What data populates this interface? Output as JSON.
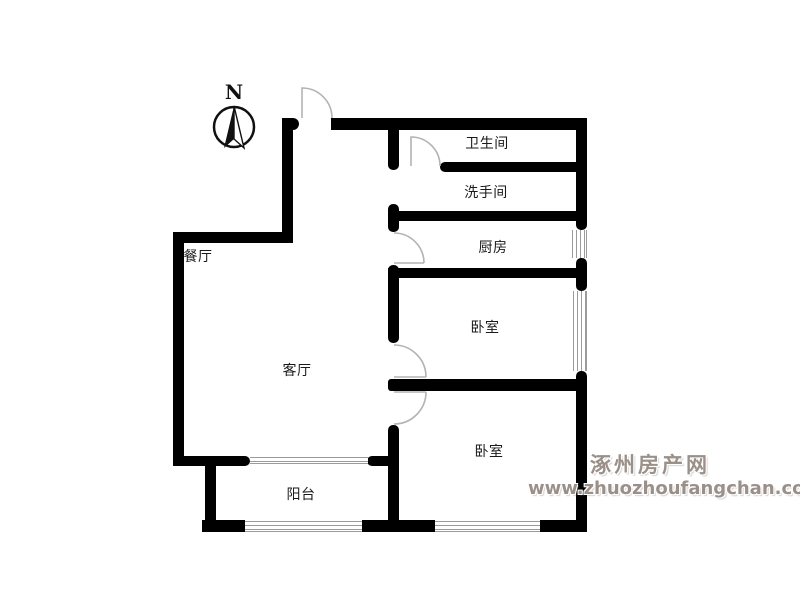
{
  "compass": {
    "label": "N"
  },
  "rooms": {
    "bathroom": "卫生间",
    "washroom": "洗手间",
    "kitchen": "厨房",
    "bedroom_north": "卧室",
    "bedroom_south": "卧室",
    "dining": "餐厅",
    "living": "客厅",
    "balcony": "阳台"
  },
  "watermark": {
    "site_name": "涿州房产网",
    "site_url": "www.zhuozhoufangchan.com"
  },
  "colors": {
    "wall": "#000000",
    "door_arc": "#b3b3b3",
    "window_line": "#9b9b9b",
    "watermark_text": "#9a9089",
    "background": "#ffffff"
  }
}
